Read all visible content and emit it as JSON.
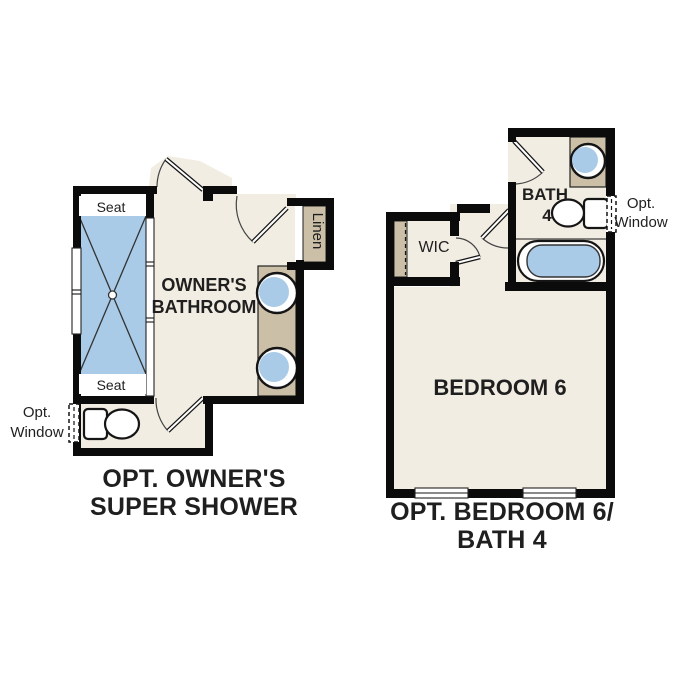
{
  "colors": {
    "background": "#ffffff",
    "room": "#f2ede3",
    "fixture_blue": "#a9cbe8",
    "cabinet_tan": "#cbbfa7",
    "wall": "#0b0b0b",
    "text": "#1f1f1f"
  },
  "left_plan": {
    "title_line1": "OPT. OWNER'S",
    "title_line2": "SUPER SHOWER",
    "room_line1": "OWNER'S",
    "room_line2": "BATHROOM",
    "seat_top": "Seat",
    "seat_bottom": "Seat",
    "linen": "Linen",
    "opt_window_line1": "Opt.",
    "opt_window_line2": "Window"
  },
  "right_plan": {
    "title_line1": "OPT. BEDROOM 6/",
    "title_line2": "BATH 4",
    "bedroom": "BEDROOM 6",
    "bath_line1": "BATH",
    "bath_line2": "4",
    "wic": "WIC",
    "opt_window_line1": "Opt.",
    "opt_window_line2": "Window"
  }
}
